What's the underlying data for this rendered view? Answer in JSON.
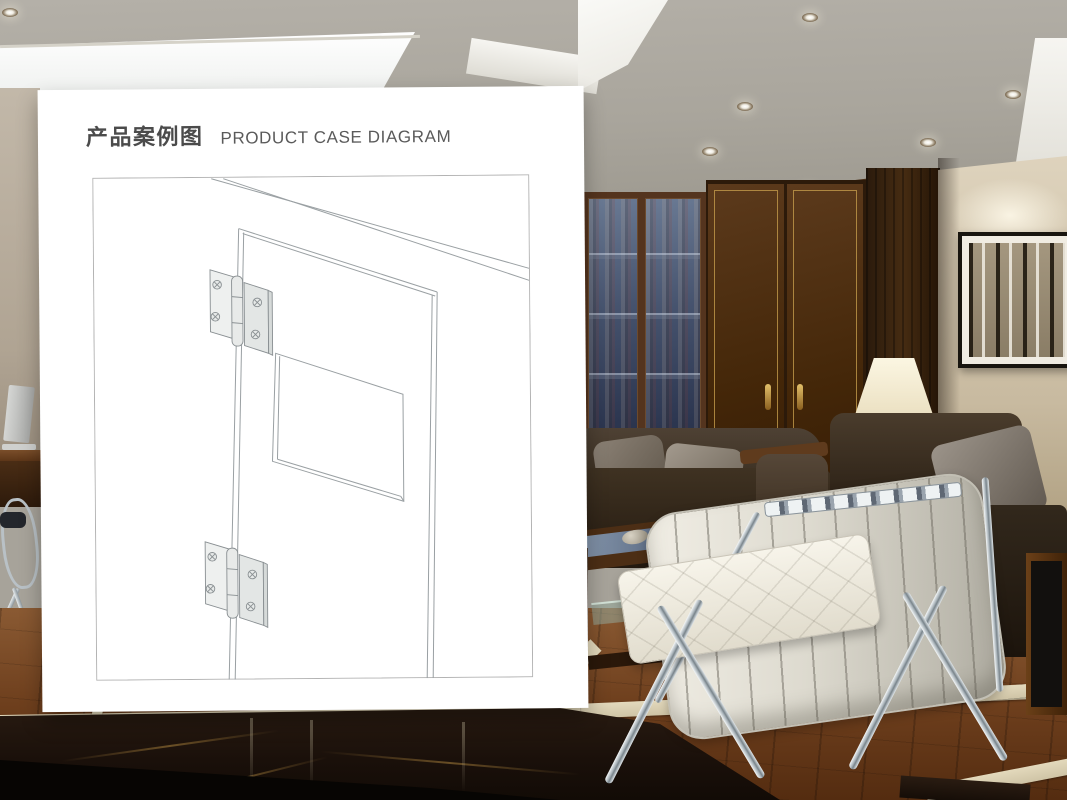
{
  "header": {
    "title_zh": "产品案例图",
    "title_en": "PRODUCT CASE DIAGRAM"
  },
  "card": {
    "background": "#ffffff",
    "title_zh_color": "#4b4b4b",
    "title_en_color": "#5a5a5a"
  },
  "diagram": {
    "kind": "perspective line drawing",
    "subject": "cabinet door with recessed window panel mounted on two butt hinges",
    "line_color": "#9aa0a3",
    "frame_border_color": "#b3b3b3",
    "door": {
      "has_recessed_window": true,
      "edge_style": "double line"
    },
    "hinges": {
      "count": 2,
      "positions": [
        "upper door edge",
        "lower door edge"
      ],
      "screws_visible_per_hinge": 4,
      "screw_head": "phillips cross",
      "fill_color": "#eef0ef",
      "outline_color": "#898f92"
    }
  },
  "background_scene": {
    "type": "interior lounge photo",
    "elements": [
      "ceiling-downlights",
      "luminous-ceiling-panel",
      "glass-bookcase",
      "burl-wood-double-door",
      "beige-wall",
      "abstract-artwork",
      "table-lamp",
      "leather-sofa-left",
      "leather-armchair-right",
      "barcelona-chair",
      "coffee-table",
      "office-desk-monitor",
      "office-chair",
      "parquet-floor-with-marble-inlay",
      "dark-marble-floor"
    ],
    "palette": {
      "ceiling": "#aba79d",
      "wood_wall": "#35210f",
      "door_trim_gold": "#c39b4b",
      "beige_wall": "#cdc1a9",
      "sofa_leather": "#2f251a",
      "white_chair_leather": "#efece2",
      "chrome": "#c9d0d4",
      "parquet": "#7a4a26",
      "marble_cream": "#ddd2b6",
      "marble_dark": "#1c120b"
    }
  }
}
